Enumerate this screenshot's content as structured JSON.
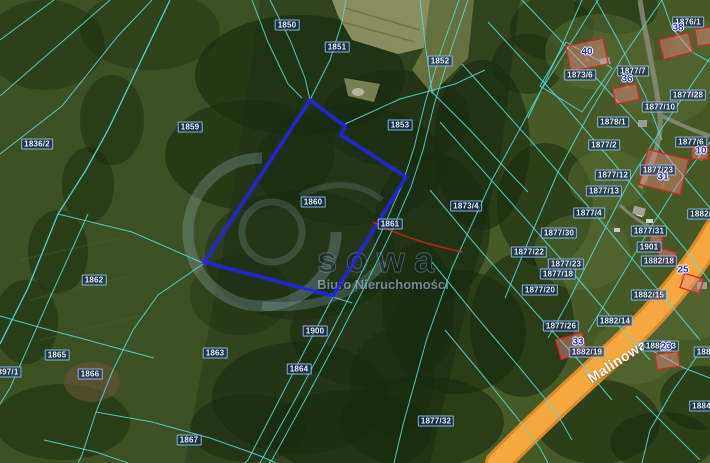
{
  "watermark": {
    "brand": "sowa",
    "caption": "Biuro Nieruchomości"
  },
  "street": {
    "name": "Malinowa"
  },
  "colors": {
    "parcel_boundary": "#54d8d8",
    "highlight_parcel": "#2222ee",
    "road": "#f5a83f",
    "building_outline": "#cf2a20",
    "house_number": "#2433cf",
    "parcel_label_bg": "#16305e",
    "watermark_text": "#a9c6dd"
  },
  "parcels": [
    {
      "label": "1850",
      "x": 287,
      "y": 25
    },
    {
      "label": "1851",
      "x": 337,
      "y": 47
    },
    {
      "label": "1852",
      "x": 440,
      "y": 61
    },
    {
      "label": "1853",
      "x": 400,
      "y": 125
    },
    {
      "label": "1859",
      "x": 190,
      "y": 127
    },
    {
      "label": "1836/2",
      "x": 37,
      "y": 144
    },
    {
      "label": "1860",
      "x": 313,
      "y": 202
    },
    {
      "label": "1861",
      "x": 390,
      "y": 224
    },
    {
      "label": "1873/4",
      "x": 466,
      "y": 206
    },
    {
      "label": "1862",
      "x": 94,
      "y": 280
    },
    {
      "label": "1865",
      "x": 57,
      "y": 355
    },
    {
      "label": "1866",
      "x": 90,
      "y": 374
    },
    {
      "label": "1863",
      "x": 215,
      "y": 353
    },
    {
      "label": "1864",
      "x": 299,
      "y": 369
    },
    {
      "label": "1900",
      "x": 315,
      "y": 331
    },
    {
      "label": "1867",
      "x": 189,
      "y": 440
    },
    {
      "label": "897/1",
      "x": 8,
      "y": 372
    },
    {
      "label": "1873/6",
      "x": 580,
      "y": 75
    },
    {
      "label": "1876/1",
      "x": 688,
      "y": 22
    },
    {
      "label": "1877/7",
      "x": 633,
      "y": 71
    },
    {
      "label": "1877/28",
      "x": 688,
      "y": 95
    },
    {
      "label": "1877/10",
      "x": 660,
      "y": 107
    },
    {
      "label": "1878/1",
      "x": 613,
      "y": 122
    },
    {
      "label": "1877/2",
      "x": 604,
      "y": 145
    },
    {
      "label": "1877/6",
      "x": 691,
      "y": 142
    },
    {
      "label": "1877/12",
      "x": 613,
      "y": 175
    },
    {
      "label": "1877/23",
      "x": 658,
      "y": 170
    },
    {
      "label": "1877/13",
      "x": 604,
      "y": 191
    },
    {
      "label": "1877/4",
      "x": 589,
      "y": 213
    },
    {
      "label": "1877/30",
      "x": 559,
      "y": 233
    },
    {
      "label": "1877/31",
      "x": 649,
      "y": 231
    },
    {
      "label": "1882/7",
      "x": 703,
      "y": 214
    },
    {
      "label": "1901",
      "x": 649,
      "y": 247
    },
    {
      "label": "1877/22",
      "x": 529,
      "y": 252
    },
    {
      "label": "1877/23",
      "x": 566,
      "y": 264
    },
    {
      "label": "1877/18",
      "x": 558,
      "y": 274
    },
    {
      "label": "1877/20",
      "x": 540,
      "y": 290
    },
    {
      "label": "1882/18",
      "x": 659,
      "y": 261
    },
    {
      "label": "1882/15",
      "x": 649,
      "y": 295
    },
    {
      "label": "1882/14",
      "x": 615,
      "y": 321
    },
    {
      "label": "1877/26",
      "x": 561,
      "y": 326
    },
    {
      "label": "1882/19",
      "x": 587,
      "y": 352
    },
    {
      "label": "1884/13",
      "x": 661,
      "y": 346
    },
    {
      "label": "1884",
      "x": 706,
      "y": 352
    },
    {
      "label": "1884/1",
      "x": 705,
      "y": 406
    },
    {
      "label": "1877/32",
      "x": 436,
      "y": 421
    }
  ],
  "houses": [
    {
      "number": "40",
      "x": 587,
      "y": 55
    },
    {
      "number": "38",
      "x": 678,
      "y": 31
    },
    {
      "number": "36",
      "x": 627,
      "y": 82
    },
    {
      "number": "31",
      "x": 663,
      "y": 180
    },
    {
      "number": "25",
      "x": 683,
      "y": 273
    },
    {
      "number": "33",
      "x": 578,
      "y": 345
    },
    {
      "number": "23",
      "x": 666,
      "y": 350
    },
    {
      "number": "10",
      "x": 701,
      "y": 154
    }
  ]
}
